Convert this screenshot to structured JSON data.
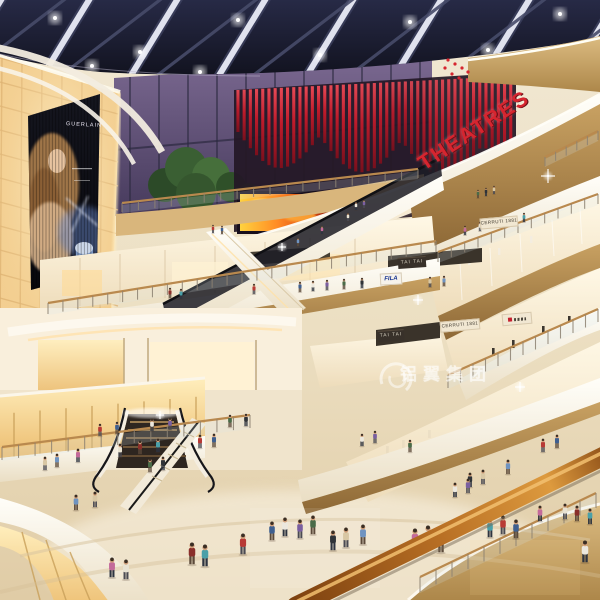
{
  "watermark": {
    "text": "铝翼集团"
  },
  "signs": {
    "theatre_marquee": "THEATRES",
    "billboard_brand": "GUERLAIN",
    "store_fila": "FILA",
    "store_tai_tai_upper": "TAI TAI",
    "store_tai_tai_lower": "TAI TAI",
    "store_cerruti_upper": "CERRUTI 1881",
    "store_cerruti_lower": "CERRUTI 1881"
  },
  "palette": {
    "ceiling_navy": "#1a1c30",
    "dusk_sky_purple": "#5c4e70",
    "theatre_red": "#c5202e",
    "fire_screen_orange": "#ff7a1a",
    "glow_amber": "#f5d9a4",
    "wood": "#c49a5e",
    "fascia_white": "#f8f3e9",
    "floor_beige": "#ead9bd",
    "handrail_wood": "#b87226"
  }
}
